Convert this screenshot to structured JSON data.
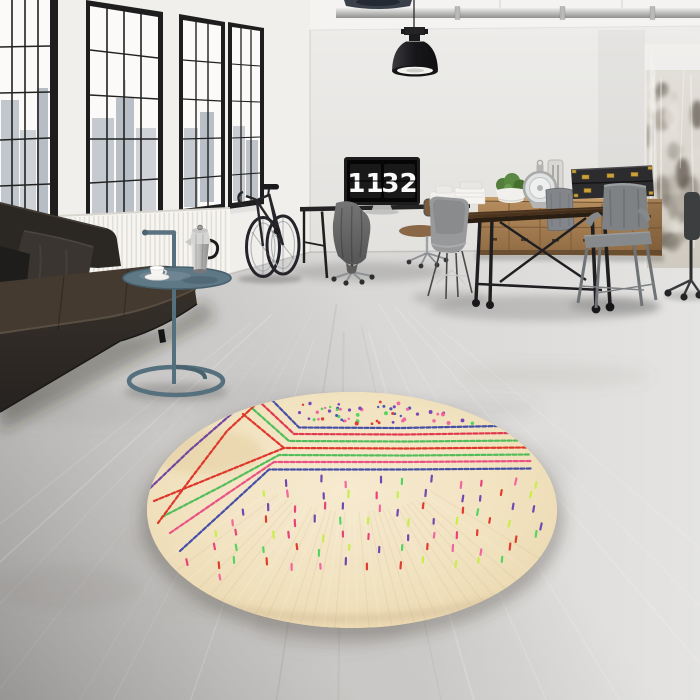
{
  "meta": {
    "subject": "Industrial loft interior with round Berber-style rug"
  },
  "clock": {
    "hours": "11",
    "minutes": "32"
  },
  "palette": {
    "left_wall": "#f0efec",
    "right_wall": "#e9e8e5",
    "ceiling": "#f4f3f1",
    "window_frame": "#1e1e1e",
    "glass": "#fbfaf8",
    "radiator": "#f6f5f2",
    "floor_base": "#d9d8d6",
    "sofa_back": "#2b2723",
    "sofa_seat": "#443a30",
    "pillow_gray": "#3a3531",
    "pillow_black": "#1f1d1b",
    "side_table": "#5b7280",
    "tray": "#5f7886",
    "moka_silver": "#cfcfcd",
    "cup_white": "#f5f4f1",
    "bike_dark": "#26262a",
    "pendant_black": "#1f1f22",
    "pipe_gray": "#c2c2c0",
    "desk_black": "#242424",
    "monitor_bezel": "#1c1c1c",
    "cloth_gray": "#6a6a6a",
    "wood_seat": "#8a6847",
    "table_wood": "#4a3424",
    "table_iron": "#1f1f22",
    "sideboard_wood": "#ab8254",
    "box_black": "#2c2c2e",
    "box_gold": "#c9a23c",
    "plant_green": "#527d3b",
    "lantern_silver": "#b0b0ae",
    "chair_gray": "#82868a",
    "eames_gray": "#97999b",
    "column_plaster": "#d7d3cc"
  },
  "rug": {
    "base": "#f2e3c3",
    "stripes": [
      {
        "name": "navy-top",
        "color": "#3d47a5"
      },
      {
        "name": "crimson-top",
        "color": "#e0314b"
      },
      {
        "name": "green-top",
        "color": "#49bb55"
      },
      {
        "name": "red-center",
        "color": "#dd2f23"
      },
      {
        "name": "green-bottom",
        "color": "#49bb55"
      },
      {
        "name": "magenta",
        "color": "#e84a7f"
      },
      {
        "name": "navy-bottom",
        "color": "#3d47a5"
      }
    ],
    "chevrons": [
      {
        "name": "purple-chevron",
        "color": "#6a3fa0"
      },
      {
        "name": "red-chevron",
        "color": "#dd2f23"
      }
    ],
    "dot_colors": [
      "#e03428",
      "#4ed45c",
      "#7340b5",
      "#3f51b5",
      "#f062a0"
    ],
    "dash_colors": [
      "#f45f9e",
      "#e03428",
      "#4ed45c",
      "#6c3fae",
      "#c6ef45",
      "#e83a77"
    ],
    "dot_count": 56,
    "dash_count": 84
  }
}
